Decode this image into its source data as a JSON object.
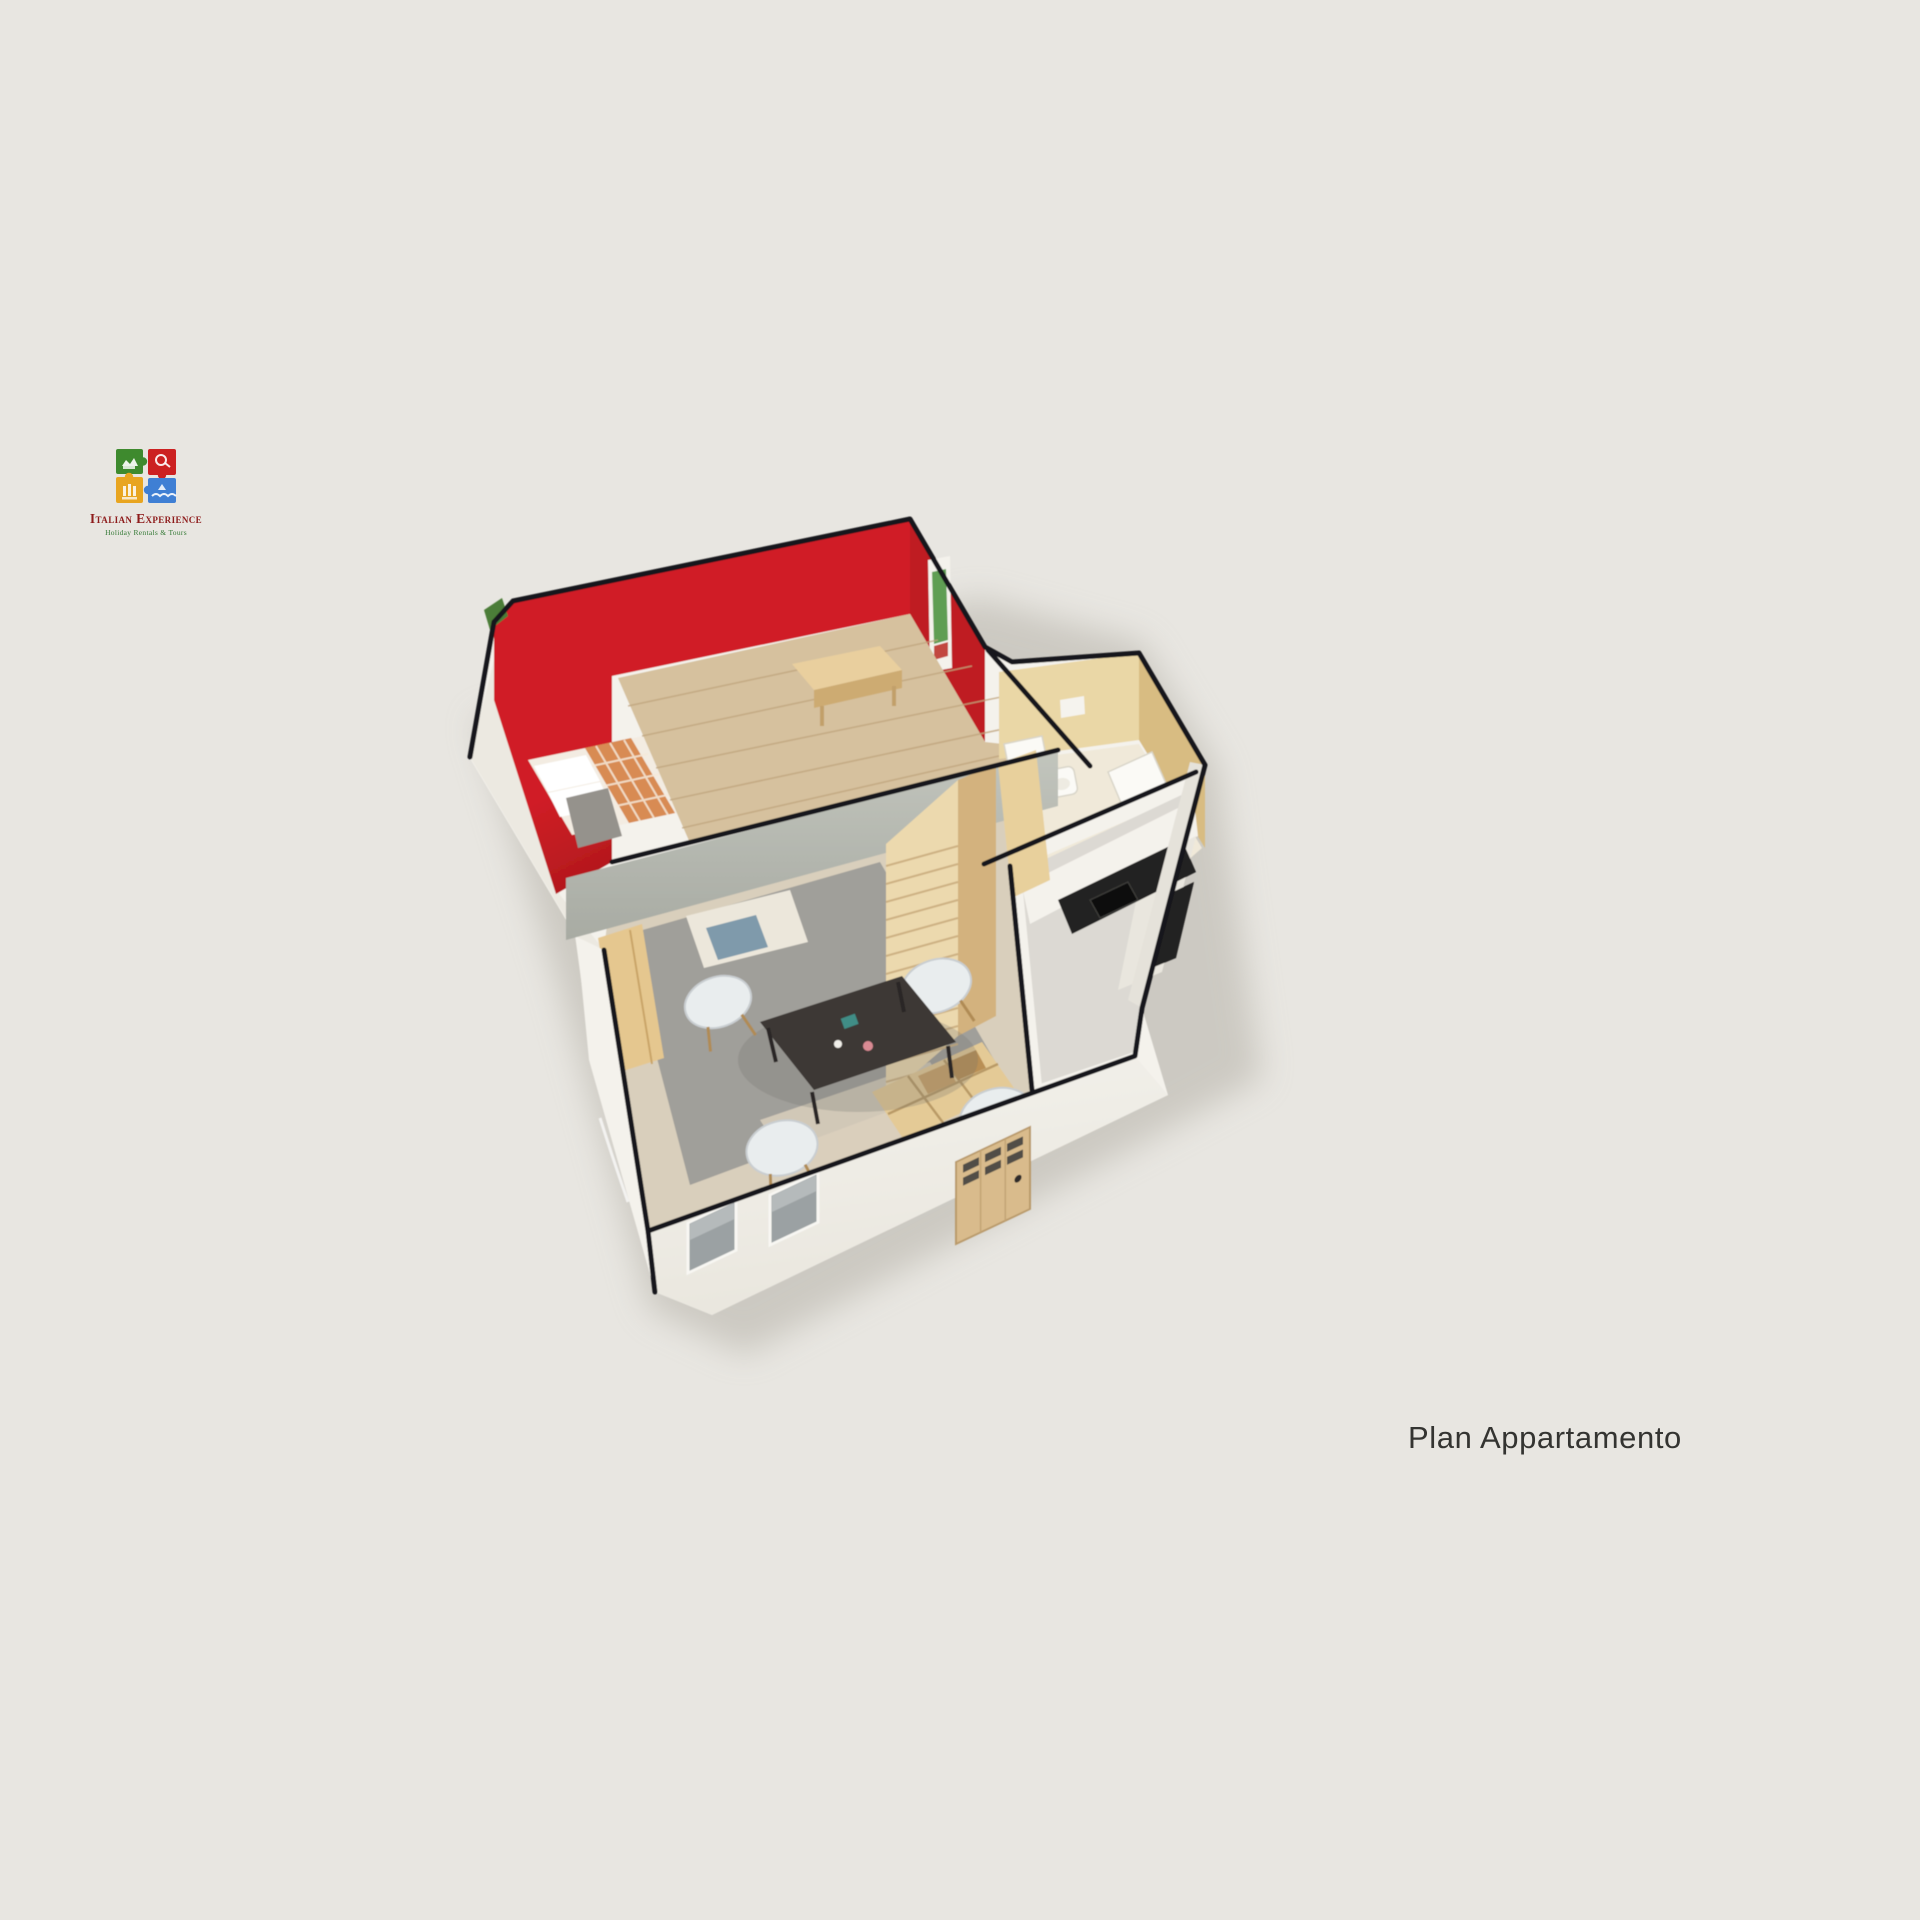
{
  "page": {
    "width": 1920,
    "height": 1920
  },
  "logo": {
    "brand": "Italian Experience",
    "tagline": "Holiday Rentals & Tours",
    "pieces": [
      "puzzle-piece-green",
      "puzzle-piece-red",
      "puzzle-piece-yellow",
      "puzzle-piece-blue"
    ]
  },
  "caption": {
    "text": "Plan Appartamento"
  },
  "floorplan": {
    "type": "3d-isometric-apartment-render",
    "elements": [
      "bedroom-red-walls",
      "mezzanine-wood-floor",
      "mezzanine-desk",
      "double-bed",
      "wall-poster",
      "bathroom",
      "kitchen",
      "staircase",
      "living-dining-room",
      "dining-table",
      "chairs",
      "front-windows",
      "entrance-door",
      "building-shadow"
    ]
  },
  "palette": {
    "bg": "#e8e6e1",
    "outline": "#17171a",
    "red_wall": "#d01f26",
    "red_wall_deep": "#9d1317",
    "red_wall_side": "#bf1b21",
    "wood_floor": "#d6c19e",
    "wood_plank_line": "#c0a57e",
    "desk_wood": "#e9cf9e",
    "desk_wood_dark": "#cdab72",
    "fascia": "#c2c5bd",
    "fascia_dark": "#a8aba3",
    "white_wall": "#f4f2ec",
    "white_wall_shade": "#e9e6de",
    "beige_wall": "#ead7a6",
    "beige_wall_dark": "#d8bc82",
    "bath_floor": "#f0e9d9",
    "kitchen_floor": "#dcd9d3",
    "counter_black": "#232120",
    "living_tile": "#d9cfbc",
    "rug_gray": "#9b9b97",
    "stair_wood": "#ecd9ae",
    "stair_side": "#d3b27e",
    "landing_wood": "#e4ca96",
    "table_dark": "#3c3835",
    "chair_white": "#e9edee",
    "chair_leg": "#b08b55",
    "bed_linen": "#f3ece2",
    "bed_plaid": "#d88b52",
    "pillow": "#ffffff",
    "window_gray": "#9ba1a3",
    "door_tan": "#d9bb8c",
    "shadow": "#b6b2a9",
    "plant_green": "#4c7d38",
    "logo_green": "#3e8a2e",
    "logo_red": "#cc2121",
    "logo_yellow": "#e8a520",
    "logo_blue": "#3f7fd4",
    "brand_red": "#8e1c1c",
    "tagline_green": "#357a36",
    "caption_ink": "#343431"
  }
}
